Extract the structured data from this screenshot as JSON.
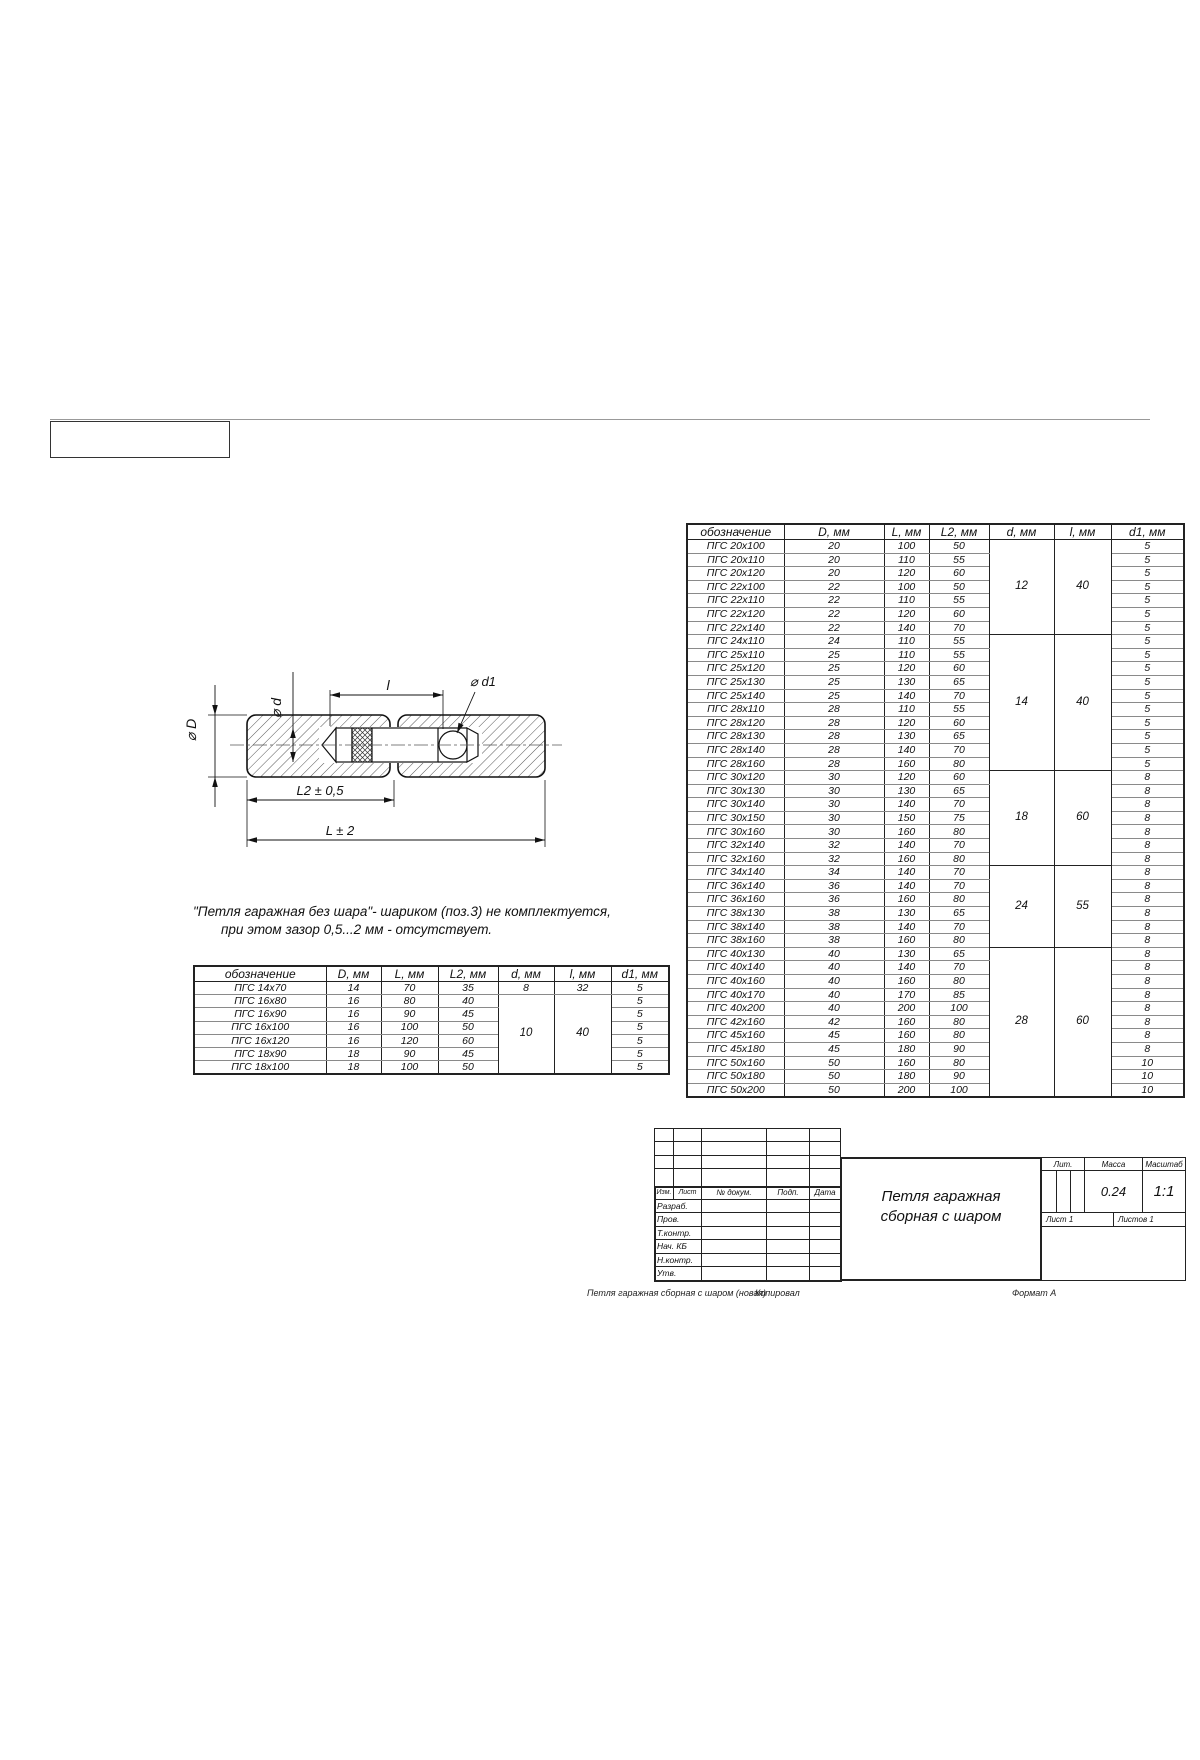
{
  "frame": {
    "note_header_box": ""
  },
  "diagram": {
    "labels": {
      "dia_d": "⌀ d",
      "l": "l",
      "dia_d1": "⌀ d1",
      "dia_D": "⌀ D",
      "L2": "L2 ± 0,5",
      "L": "L ± 2"
    }
  },
  "note": {
    "line1": "\"Петля гаражная без шара\"- шариком (поз.3) не комплектуется,",
    "line2": "при этом зазор 0,5...2 мм - отсутствует."
  },
  "small_table": {
    "headers": [
      "обозначение",
      "D, мм",
      "L, мм",
      "L2, мм",
      "d, мм",
      "l, мм",
      "d1, мм"
    ],
    "rows": [
      [
        "ПГС 14x70",
        "14",
        "70",
        "35",
        "8",
        "32",
        "5"
      ],
      [
        "ПГС 16x80",
        "16",
        "80",
        "40",
        {
          "t": "10",
          "rs": 6
        },
        {
          "t": "40",
          "rs": 6
        },
        "5"
      ],
      [
        "ПГС 16x90",
        "16",
        "90",
        "45",
        "5"
      ],
      [
        "ПГС 16x100",
        "16",
        "100",
        "50",
        "5"
      ],
      [
        "ПГС 16x120",
        "16",
        "120",
        "60",
        "5"
      ],
      [
        "ПГС 18x90",
        "18",
        "90",
        "45",
        "5"
      ],
      [
        "ПГС 18x100",
        "18",
        "100",
        "50",
        "5"
      ]
    ]
  },
  "big_table": {
    "headers": [
      "обозначение",
      "D, мм",
      "L, мм",
      "L2, мм",
      "d, мм",
      "l, мм",
      "d1, мм"
    ],
    "rows": [
      [
        "ПГС 20x100",
        "20",
        "100",
        "50",
        {
          "t": "12",
          "rs": 7
        },
        {
          "t": "40",
          "rs": 7
        },
        "5"
      ],
      [
        "ПГС 20x110",
        "20",
        "110",
        "55",
        "5"
      ],
      [
        "ПГС 20x120",
        "20",
        "120",
        "60",
        "5"
      ],
      [
        "ПГС 22x100",
        "22",
        "100",
        "50",
        "5"
      ],
      [
        "ПГС 22x110",
        "22",
        "110",
        "55",
        "5"
      ],
      [
        "ПГС 22x120",
        "22",
        "120",
        "60",
        "5"
      ],
      [
        "ПГС 22x140",
        "22",
        "140",
        "70",
        "5"
      ],
      [
        "ПГС 24x110",
        "24",
        "110",
        "55",
        {
          "t": "14",
          "rs": 10
        },
        {
          "t": "40",
          "rs": 10
        },
        "5"
      ],
      [
        "ПГС 25x110",
        "25",
        "110",
        "55",
        "5"
      ],
      [
        "ПГС 25x120",
        "25",
        "120",
        "60",
        "5"
      ],
      [
        "ПГС 25x130",
        "25",
        "130",
        "65",
        "5"
      ],
      [
        "ПГС 25x140",
        "25",
        "140",
        "70",
        "5"
      ],
      [
        "ПГС 28x110",
        "28",
        "110",
        "55",
        "5"
      ],
      [
        "ПГС 28x120",
        "28",
        "120",
        "60",
        "5"
      ],
      [
        "ПГС 28x130",
        "28",
        "130",
        "65",
        "5"
      ],
      [
        "ПГС 28x140",
        "28",
        "140",
        "70",
        "5"
      ],
      [
        "ПГС 28x160",
        "28",
        "160",
        "80",
        "5"
      ],
      [
        "ПГС 30x120",
        "30",
        "120",
        "60",
        {
          "t": "18",
          "rs": 7
        },
        {
          "t": "60",
          "rs": 7
        },
        "8"
      ],
      [
        "ПГС 30x130",
        "30",
        "130",
        "65",
        "8"
      ],
      [
        "ПГС 30x140",
        "30",
        "140",
        "70",
        "8"
      ],
      [
        "ПГС 30x150",
        "30",
        "150",
        "75",
        "8"
      ],
      [
        "ПГС 30x160",
        "30",
        "160",
        "80",
        "8"
      ],
      [
        "ПГС 32x140",
        "32",
        "140",
        "70",
        "8"
      ],
      [
        "ПГС 32x160",
        "32",
        "160",
        "80",
        "8"
      ],
      [
        "ПГС 34x140",
        "34",
        "140",
        "70",
        {
          "t": "24",
          "rs": 6
        },
        {
          "t": "55",
          "rs": 6
        },
        "8"
      ],
      [
        "ПГС 36x140",
        "36",
        "140",
        "70",
        "8"
      ],
      [
        "ПГС 36x160",
        "36",
        "160",
        "80",
        "8"
      ],
      [
        "ПГС 38x130",
        "38",
        "130",
        "65",
        "8"
      ],
      [
        "ПГС 38x140",
        "38",
        "140",
        "70",
        "8"
      ],
      [
        "ПГС 38x160",
        "38",
        "160",
        "80",
        "8"
      ],
      [
        "ПГС 40x130",
        "40",
        "130",
        "65",
        {
          "t": "28",
          "rs": 11
        },
        {
          "t": "60",
          "rs": 11
        },
        "8"
      ],
      [
        "ПГС 40x140",
        "40",
        "140",
        "70",
        "8"
      ],
      [
        "ПГС 40x160",
        "40",
        "160",
        "80",
        "8"
      ],
      [
        "ПГС 40x170",
        "40",
        "170",
        "85",
        "8"
      ],
      [
        "ПГС 40x200",
        "40",
        "200",
        "100",
        "8"
      ],
      [
        "ПГС 42x160",
        "42",
        "160",
        "80",
        "8"
      ],
      [
        "ПГС 45x160",
        "45",
        "160",
        "80",
        "8"
      ],
      [
        "ПГС 45x180",
        "45",
        "180",
        "90",
        "8"
      ],
      [
        "ПГС 50x160",
        "50",
        "160",
        "80",
        "10"
      ],
      [
        "ПГС 50x180",
        "50",
        "180",
        "90",
        "10"
      ],
      [
        "ПГС 50x200",
        "50",
        "200",
        "100",
        "10"
      ]
    ]
  },
  "title_block": {
    "header_row": [
      "Изм.",
      "Лист",
      "№ докум.",
      "Подп.",
      "Дата"
    ],
    "left_labels": [
      "Разраб.",
      "Пров.",
      "Т.контр.",
      "Нач. КБ",
      "Н.контр.",
      "Утв."
    ],
    "title_line1": "Петля гаражная",
    "title_line2": "сборная с шаром",
    "lit_label": "Лит.",
    "mass_label": "Масса",
    "scale_label": "Масштаб",
    "mass_value": "0.24",
    "scale_value": "1:1",
    "sheet_label": "Лист 1",
    "sheets_label": "Листов 1"
  },
  "footer": {
    "left_caption": "Петля гаражная сборная с шаром (новая)",
    "copied": "Копировал",
    "format": "Формат А"
  }
}
